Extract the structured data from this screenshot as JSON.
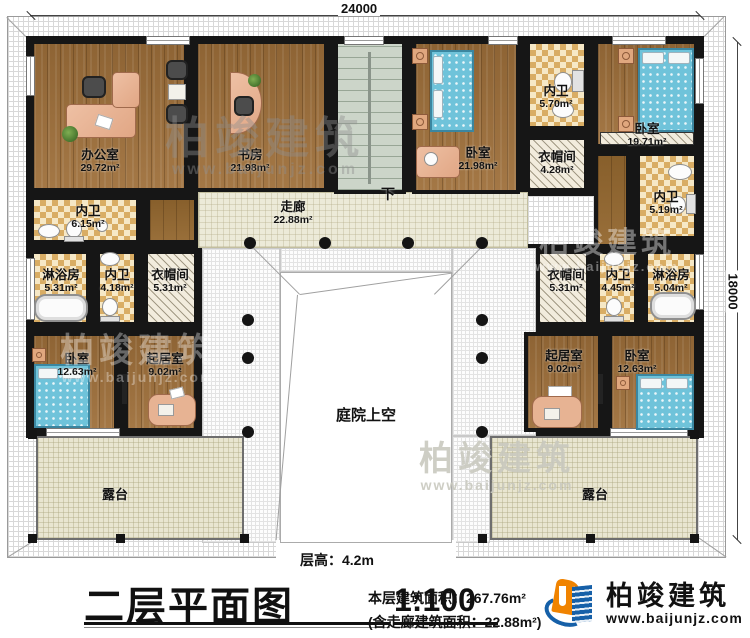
{
  "dims": {
    "top": "24000",
    "right": "18000"
  },
  "rooms": {
    "office": {
      "label": "办公室",
      "area": "29.72m²"
    },
    "study": {
      "label": "书房",
      "area": "21.98m²"
    },
    "bedroom_top": {
      "label": "卧室",
      "area": "21.98m²"
    },
    "bath_top": {
      "label": "内卫",
      "area": "5.70m²"
    },
    "closet_top": {
      "label": "衣帽间",
      "area": "4.28m²"
    },
    "bedroom_topright": {
      "label": "卧室",
      "area": "19.71m²"
    },
    "bath_righttop": {
      "label": "内卫",
      "area": "5.19m²"
    },
    "corridor": {
      "label": "走廊",
      "area": "22.88m²"
    },
    "bath_lefttop": {
      "label": "内卫",
      "area": "6.15m²"
    },
    "shower_left": {
      "label": "淋浴房",
      "area": "5.31m²"
    },
    "bath_left": {
      "label": "内卫",
      "area": "4.18m²"
    },
    "closet_left": {
      "label": "衣帽间",
      "area": "5.31m²"
    },
    "bedroom_left": {
      "label": "卧室",
      "area": "12.63m²"
    },
    "living_left": {
      "label": "起居室",
      "area": "9.02m²"
    },
    "closet_right": {
      "label": "衣帽间",
      "area": "5.31m²"
    },
    "bath_right": {
      "label": "内卫",
      "area": "4.45m²"
    },
    "shower_right": {
      "label": "淋浴房",
      "area": "5.04m²"
    },
    "living_right": {
      "label": "起居室",
      "area": "9.02m²"
    },
    "bedroom_right": {
      "label": "卧室",
      "area": "12.63m²"
    },
    "terrace_left": {
      "label": "露台"
    },
    "terrace_right": {
      "label": "露台"
    },
    "courtyard": {
      "label": "庭院上空"
    },
    "stair": {
      "label": "下"
    }
  },
  "title_block": {
    "floor_height": "层高：4.2m",
    "title": "二层平面图",
    "scale": "1:100",
    "area_main": "本层建筑面积：267.76m²",
    "area_note": "(含走廊建筑面积：22.88m²)"
  },
  "brand": {
    "name": "柏竣建筑",
    "url": "www.baijunjz.com"
  },
  "watermark": {
    "name": "柏竣建筑",
    "url": "www.baijunjz.com"
  },
  "colors": {
    "wall": "#161616",
    "wood_floor": "#9e6f3a",
    "bath_tile": "#f6e8c6",
    "bed": "#6fc3da",
    "corridor_floor": "#ecead8",
    "brand_blue": "#1660a8",
    "brand_orange": "#f08300"
  }
}
